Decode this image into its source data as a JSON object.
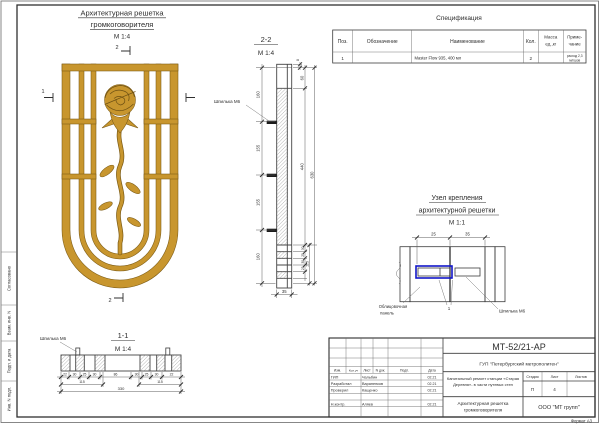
{
  "colors": {
    "gold": "#C8962E",
    "gold_outline": "#7a5a15",
    "highlight_blue": "#1216c8",
    "line": "#3c3c3c"
  },
  "sheet": {
    "format": "Формат  А3"
  },
  "margin": {
    "soglasovano": "Согласовано",
    "vzam": "Взам. инв. N",
    "podp_data": "Подп. и дата",
    "inv_podl": "Инв. N подл."
  },
  "front": {
    "title1": "Архитектурная решетка",
    "title2": "громкоговорителя",
    "scale": "М 1:4",
    "sec2": "2",
    "sec1": "1"
  },
  "sec22": {
    "title": "2-2",
    "scale": "М 1:4",
    "stud": "Шпилька М6",
    "d160a": "160",
    "d155a": "155",
    "d155b": "155",
    "d160b": "160",
    "d60": "60",
    "d440": "440",
    "d630": "630",
    "d8": "8",
    "d35": "35",
    "d115": "115",
    "b1": "30",
    "b2": "25",
    "b3": "30",
    "b4": "25"
  },
  "sec11": {
    "title": "1-1",
    "scale": "М 1:4",
    "stud": "Шпилька М6",
    "dims": [
      "22",
      "30",
      "25",
      "30",
      "86",
      "30",
      "25",
      "30",
      "22"
    ],
    "d115a": "115",
    "d115b": "115",
    "d330": "330"
  },
  "node": {
    "t1": "Узел крепления",
    "t2": "архитектурной решетки",
    "scale": "М 1:1",
    "d25": "25",
    "d35": "35",
    "panel1": "Облицовочная",
    "panel2": "панель",
    "ref": "1",
    "stud": "Шпилька М6"
  },
  "spec": {
    "title": "Спецификация",
    "h_pos": "Поз.",
    "h_obozn": "Обозначение",
    "h_name": "Наименование",
    "h_qty": "Кол.",
    "h_mass1": "Масса",
    "h_mass2": "ед.,кг",
    "h_note1": "Приме-",
    "h_note2": "чание",
    "r1_pos": "1",
    "r1_name": "Master Flow 935, 400 мл",
    "r1_qty": "2",
    "r1_note1": "расход 2,3",
    "r1_note2": "мл/шов"
  },
  "tb": {
    "doc": "МТ-52/21-АР",
    "company": "ГУП \"Петербургский метрополитен\"",
    "proj1": "Капитальный ремонт станции «Старая",
    "proj2": "Деревня»- в части путевых стен",
    "name1": "Архитектурная решетка",
    "name2": "громкоговорителя",
    "org": "ООО \"МТ групп\"",
    "stage_h": "Стадия",
    "list_h": "Лист",
    "listov_h": "Листов",
    "stage": "П",
    "list": "4",
    "c_izm": "Изм.",
    "c_koluch": "Кол.уч",
    "c_list": "Лист",
    "c_ndok": "N док.",
    "c_podp": "Подп.",
    "c_data": "Дата",
    "r1_role": "ГИП",
    "r1_name": "Чальбин",
    "r1_date": "02.21",
    "r2_role": "Разработал",
    "r2_name": "Вараненков",
    "r2_date": "02.21",
    "r3_role": "Проверил",
    "r3_name": "Кащенко",
    "r3_date": "02.21",
    "r4_role": "Н.контр.",
    "r4_name": "Аляев",
    "r4_date": "02.21"
  }
}
